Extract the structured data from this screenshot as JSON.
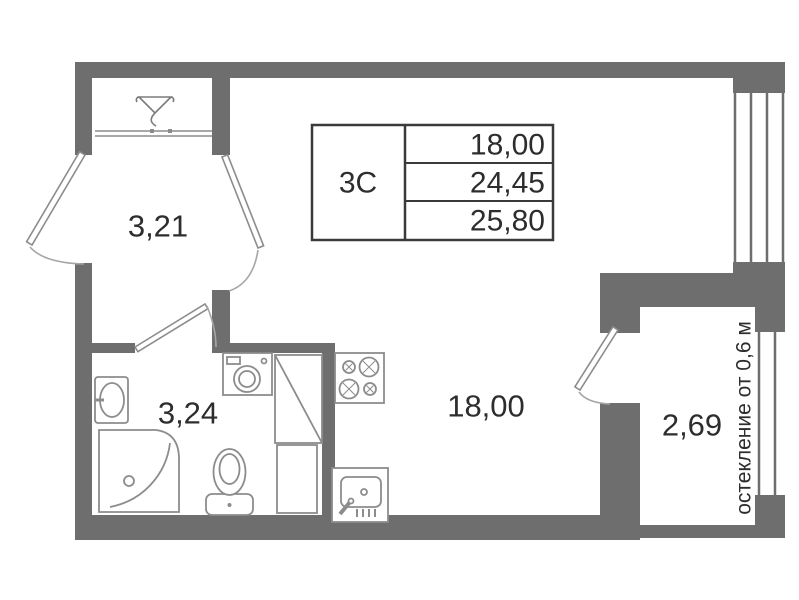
{
  "colors": {
    "wall": "#6e6e6e",
    "fixture": "#8c8c8c",
    "arc": "#a6a6a6",
    "table_border": "#3a3a3a",
    "text": "#2d2d2d"
  },
  "info_table": {
    "unit_label": "3С",
    "rows": [
      {
        "value": "18,00"
      },
      {
        "value": "24,45"
      },
      {
        "value": "25,80"
      }
    ]
  },
  "rooms": {
    "hall_area": "3,21",
    "bathroom_area": "3,24",
    "living_area": "18,00",
    "balcony_area": "2,69"
  },
  "notes": {
    "glazing": "остекление от 0,6 м"
  }
}
